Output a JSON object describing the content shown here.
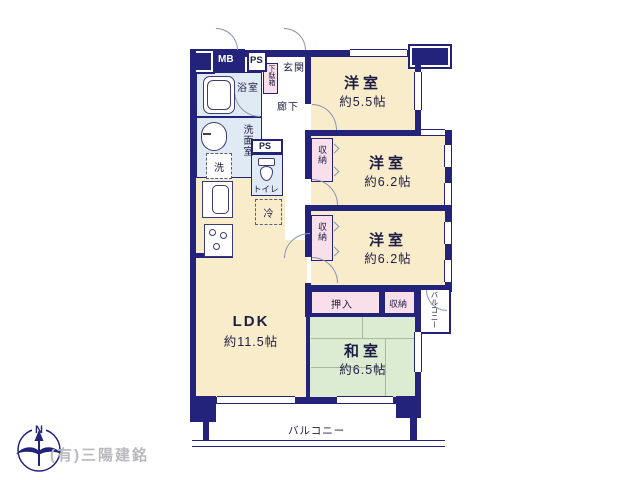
{
  "rooms": {
    "western1": {
      "label": "洋室",
      "size": "約5.5帖"
    },
    "western2": {
      "label": "洋室",
      "size": "約6.2帖"
    },
    "western3": {
      "label": "洋室",
      "size": "約6.2帖"
    },
    "ldk": {
      "label": "LDK",
      "size": "約11.5帖"
    },
    "japanese": {
      "label": "和室",
      "size": "約6.5帖"
    }
  },
  "labels": {
    "mb": "MB",
    "ps": "PS",
    "genkan": "玄関",
    "getabako": "下駄箱",
    "rouka": "廊下",
    "bathroom": "浴室",
    "washroom": "洗面室",
    "washer": "洗",
    "toilet": "トイレ",
    "fridge": "冷",
    "closet": "収納",
    "oshiire": "押入",
    "balcony": "バルコニー",
    "north": "N"
  },
  "credit": "(有)三陽建銘",
  "colors": {
    "wall": "#23237b",
    "western_room": "#f9ecca",
    "japanese_room": "#dcecd2",
    "closet": "#f8dfe9",
    "wet_area": "#e0eaf4",
    "credit_text": "#b9b9bd"
  }
}
